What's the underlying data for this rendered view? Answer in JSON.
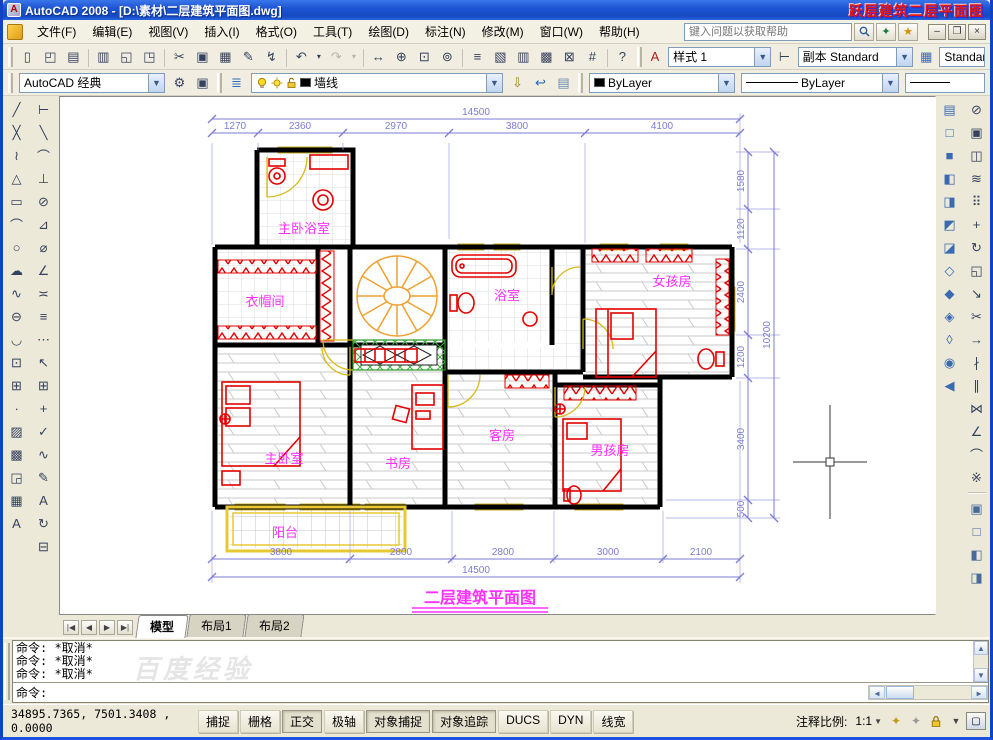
{
  "title_bar": {
    "title": "AutoCAD 2008 - [D:\\素材\\二层建筑平面图.dwg]",
    "app_logo_letter": "A",
    "watermark": "跃层建筑二层平面图"
  },
  "menu_bar": {
    "items": [
      {
        "name": "menu-file",
        "label": "文件(F)"
      },
      {
        "name": "menu-edit",
        "label": "编辑(E)"
      },
      {
        "name": "menu-view",
        "label": "视图(V)"
      },
      {
        "name": "menu-insert",
        "label": "插入(I)"
      },
      {
        "name": "menu-format",
        "label": "格式(O)"
      },
      {
        "name": "menu-tools",
        "label": "工具(T)"
      },
      {
        "name": "menu-draw",
        "label": "绘图(D)"
      },
      {
        "name": "menu-dimension",
        "label": "标注(N)"
      },
      {
        "name": "menu-modify",
        "label": "修改(M)"
      },
      {
        "name": "menu-window",
        "label": "窗口(W)"
      },
      {
        "name": "menu-help",
        "label": "帮助(H)"
      }
    ],
    "search_placeholder": "键入问题以获取帮助",
    "minimize_glyph": "–",
    "restore_glyph": "❐",
    "close_glyph": "×",
    "star_glyph": "★"
  },
  "standard_toolbar": {
    "buttons": [
      {
        "name": "new-icon",
        "glyph": "▯"
      },
      {
        "name": "open-icon",
        "glyph": "◰"
      },
      {
        "name": "save-icon",
        "glyph": "▤"
      },
      {
        "name": "plot-icon",
        "glyph": "▥",
        "cls": "grp-start"
      },
      {
        "name": "plot-preview-icon",
        "glyph": "◱"
      },
      {
        "name": "publish-icon",
        "glyph": "◳"
      },
      {
        "name": "cut-icon",
        "glyph": "✂",
        "cls": "grp-start"
      },
      {
        "name": "copy-icon",
        "glyph": "▣"
      },
      {
        "name": "paste-icon",
        "glyph": "▦"
      },
      {
        "name": "match-properties-icon",
        "glyph": "✎"
      },
      {
        "name": "block-editor-icon",
        "glyph": "↯"
      },
      {
        "name": "undo-icon",
        "glyph": "↶",
        "cls": "grp-start"
      },
      {
        "name": "undo-menu-icon",
        "glyph": "▾",
        "cls": "narrow"
      },
      {
        "name": "redo-icon",
        "glyph": "↷",
        "cls": "disabled"
      },
      {
        "name": "redo-menu-icon",
        "glyph": "▾",
        "cls": "narrow disabled"
      },
      {
        "name": "pan-icon",
        "glyph": "↔",
        "cls": "grp-start"
      },
      {
        "name": "zoom-realtime-icon",
        "glyph": "⊕"
      },
      {
        "name": "zoom-window-icon",
        "glyph": "⊡"
      },
      {
        "name": "zoom-previous-icon",
        "glyph": "⊚"
      },
      {
        "name": "properties-icon",
        "glyph": "≡",
        "cls": "grp-start"
      },
      {
        "name": "designcenter-icon",
        "glyph": "▧"
      },
      {
        "name": "tool-palettes-icon",
        "glyph": "▥"
      },
      {
        "name": "sheet-set-manager-icon",
        "glyph": "▩"
      },
      {
        "name": "markup-set-manager-icon",
        "glyph": "⊠"
      },
      {
        "name": "quickcalc-icon",
        "glyph": "#"
      },
      {
        "name": "help-icon",
        "glyph": "?",
        "cls": "grp-start"
      }
    ]
  },
  "styles_toolbar": {
    "text_style_icon": "A",
    "text_style": "样式 1",
    "dim_style_icon": "⊢",
    "dim_style": "副本 Standard",
    "table_style_icon": "▦",
    "table_style": "Standard"
  },
  "workspace_toolbar": {
    "workspace": "AutoCAD 经典",
    "settings_glyph": "⚙",
    "save_glyph": "▣"
  },
  "layers_toolbar": {
    "manager_glyph": "≣",
    "layer": "墙线",
    "make_current_glyph": "⇩",
    "previous_glyph": "↩",
    "states_glyph": "▤"
  },
  "properties_toolbar": {
    "color": "ByLayer",
    "linetype": "ByLayer"
  },
  "draw_toolbar": {
    "buttons": [
      {
        "name": "line-icon",
        "glyph": "╱"
      },
      {
        "name": "construction-line-icon",
        "glyph": "╳"
      },
      {
        "name": "polyline-icon",
        "glyph": "≀"
      },
      {
        "name": "polygon-icon",
        "glyph": "△"
      },
      {
        "name": "rectangle-icon",
        "glyph": "▭"
      },
      {
        "name": "arc-icon",
        "glyph": "⌒"
      },
      {
        "name": "circle-icon",
        "glyph": "○"
      },
      {
        "name": "revcloud-icon",
        "glyph": "☁"
      },
      {
        "name": "spline-icon",
        "glyph": "∿"
      },
      {
        "name": "ellipse-icon",
        "glyph": "⊖"
      },
      {
        "name": "ellipse-arc-icon",
        "glyph": "◡"
      },
      {
        "name": "insert-block-icon",
        "glyph": "⊡"
      },
      {
        "name": "make-block-icon",
        "glyph": "⊞"
      },
      {
        "name": "point-icon",
        "glyph": "∙"
      },
      {
        "name": "hatch-icon",
        "glyph": "▨"
      },
      {
        "name": "gradient-icon",
        "glyph": "▩"
      },
      {
        "name": "region-icon",
        "glyph": "◲"
      },
      {
        "name": "table-icon",
        "glyph": "▦"
      },
      {
        "name": "mtext-icon",
        "glyph": "A"
      }
    ]
  },
  "dimension_toolbar": {
    "buttons": [
      {
        "name": "dim-linear-icon",
        "glyph": "⊢"
      },
      {
        "name": "dim-aligned-icon",
        "glyph": "╲"
      },
      {
        "name": "dim-arc-length-icon",
        "glyph": "⌒"
      },
      {
        "name": "dim-ordinate-icon",
        "glyph": "⊥"
      },
      {
        "name": "dim-radius-icon",
        "glyph": "⊘"
      },
      {
        "name": "dim-jogged-icon",
        "glyph": "⊿"
      },
      {
        "name": "dim-diameter-icon",
        "glyph": "⌀"
      },
      {
        "name": "dim-angular-icon",
        "glyph": "∠"
      },
      {
        "name": "quick-dim-icon",
        "glyph": "≍"
      },
      {
        "name": "dim-baseline-icon",
        "glyph": "≡"
      },
      {
        "name": "dim-continue-icon",
        "glyph": "⋯"
      },
      {
        "name": "quick-leader-icon",
        "glyph": "↖"
      },
      {
        "name": "tolerance-icon",
        "glyph": "⊞"
      },
      {
        "name": "center-mark-icon",
        "glyph": "+"
      },
      {
        "name": "dim-inspect-icon",
        "glyph": "✓"
      },
      {
        "name": "dim-jogline-icon",
        "glyph": "∿"
      },
      {
        "name": "dim-edit-icon",
        "glyph": "✎"
      },
      {
        "name": "dim-text-edit-icon",
        "glyph": "A"
      },
      {
        "name": "dim-update-icon",
        "glyph": "↻"
      },
      {
        "name": "dim-style-icon",
        "glyph": "⊟"
      }
    ]
  },
  "view_toolbar": {
    "buttons": [
      {
        "name": "named-views-icon",
        "glyph": "▤"
      },
      {
        "name": "view-top-icon",
        "glyph": "□"
      },
      {
        "name": "view-bottom-icon",
        "glyph": "■"
      },
      {
        "name": "view-left-icon",
        "glyph": "◧"
      },
      {
        "name": "view-right-icon",
        "glyph": "◨"
      },
      {
        "name": "view-front-icon",
        "glyph": "◩"
      },
      {
        "name": "view-back-icon",
        "glyph": "◪"
      },
      {
        "name": "view-sw-iso-icon",
        "glyph": "◇"
      },
      {
        "name": "view-se-iso-icon",
        "glyph": "◆"
      },
      {
        "name": "view-ne-iso-icon",
        "glyph": "◈"
      },
      {
        "name": "view-nw-iso-icon",
        "glyph": "◊"
      },
      {
        "name": "camera-icon",
        "glyph": "◉"
      },
      {
        "name": "previous-view-icon",
        "glyph": "◀"
      }
    ]
  },
  "modify_toolbar": {
    "buttons": [
      {
        "name": "erase-icon",
        "glyph": "⊘"
      },
      {
        "name": "copy-object-icon",
        "glyph": "▣"
      },
      {
        "name": "mirror-icon",
        "glyph": "◫"
      },
      {
        "name": "offset-icon",
        "glyph": "≋"
      },
      {
        "name": "array-icon",
        "glyph": "⠿"
      },
      {
        "name": "move-icon",
        "glyph": "+"
      },
      {
        "name": "rotate-icon",
        "glyph": "↻"
      },
      {
        "name": "scale-icon",
        "glyph": "◱"
      },
      {
        "name": "stretch-icon",
        "glyph": "↘"
      },
      {
        "name": "trim-icon",
        "glyph": "✂"
      },
      {
        "name": "extend-icon",
        "glyph": "→"
      },
      {
        "name": "break-at-point-icon",
        "glyph": "∤"
      },
      {
        "name": "break-icon",
        "glyph": "∥"
      },
      {
        "name": "join-icon",
        "glyph": "⋈"
      },
      {
        "name": "chamfer-icon",
        "glyph": "∠"
      },
      {
        "name": "fillet-icon",
        "glyph": "⌒"
      },
      {
        "name": "explode-icon",
        "glyph": "※"
      }
    ]
  },
  "order_toolbar": {
    "buttons": [
      {
        "name": "bring-to-front-icon",
        "glyph": "▣"
      },
      {
        "name": "send-to-back-icon",
        "glyph": "□"
      },
      {
        "name": "bring-above-icon",
        "glyph": "◧"
      },
      {
        "name": "send-under-icon",
        "glyph": "◨"
      }
    ]
  },
  "drawing": {
    "rooms": {
      "master_bath": "主卧浴室",
      "closet": "衣帽间",
      "bath": "浴室",
      "girl": "女孩房",
      "master": "主卧室",
      "study": "书房",
      "guest": "客房",
      "boy": "男孩房",
      "balcony": "阳台"
    },
    "plan_title": "二层建筑平面图",
    "dims_top": {
      "total": "14500",
      "segments": [
        "1270",
        "2360",
        "2970",
        "3800",
        "4100"
      ]
    },
    "dims_bottom": {
      "total": "14500",
      "segments": [
        "3800",
        "2800",
        "2800",
        "3000",
        "2100"
      ]
    },
    "dims_right": {
      "total": "10200",
      "segments": [
        "1580",
        "1120",
        "2400",
        "1200",
        "3400",
        "500"
      ]
    }
  },
  "layout_tabs": {
    "tabs": [
      {
        "name": "tab-model",
        "label": "模型",
        "state": "active"
      },
      {
        "name": "tab-layout1",
        "label": "布局1"
      },
      {
        "name": "tab-layout2",
        "label": "布局2"
      }
    ]
  },
  "command_window": {
    "history": [
      {
        "text": "命令: *取消*"
      },
      {
        "text": "命令: *取消*"
      },
      {
        "text": "命令: *取消*"
      }
    ],
    "prompt": "命令:",
    "watermark": "百度经验"
  },
  "status_bar": {
    "coordinates": "34895.7365, 7501.3408 , 0.0000",
    "toggles": [
      {
        "name": "toggle-snap",
        "label": "捕捉"
      },
      {
        "name": "toggle-grid",
        "label": "栅格"
      },
      {
        "name": "toggle-ortho",
        "label": "正交",
        "state": "pressed"
      },
      {
        "name": "toggle-polar",
        "label": "极轴"
      },
      {
        "name": "toggle-osnap",
        "label": "对象捕捉",
        "state": "pressed"
      },
      {
        "name": "toggle-otrack",
        "label": "对象追踪",
        "state": "pressed"
      },
      {
        "name": "toggle-ducs",
        "label": "DUCS"
      },
      {
        "name": "toggle-dyn",
        "label": "DYN"
      },
      {
        "name": "toggle-lwt",
        "label": "线宽"
      }
    ],
    "annotation_scale_label": "注释比例:",
    "annotation_scale": "1:1"
  }
}
